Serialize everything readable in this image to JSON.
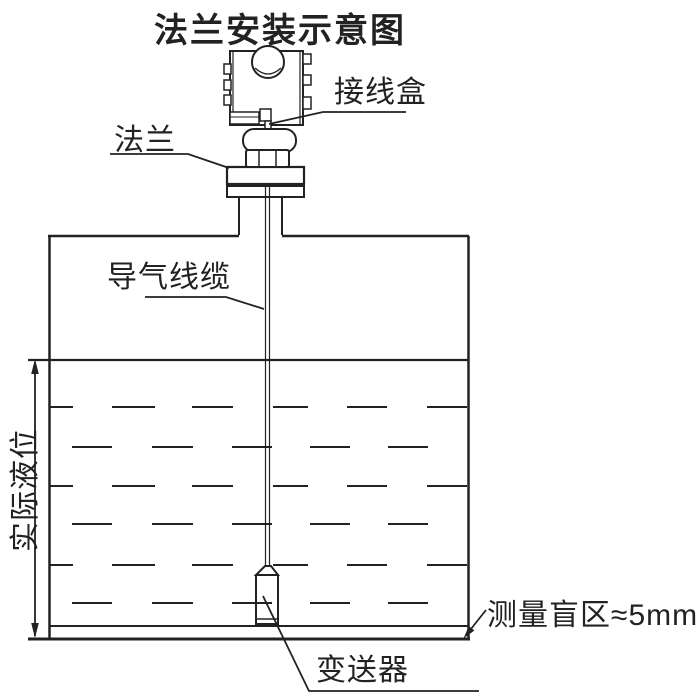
{
  "title": "法兰安装示意图",
  "labels": {
    "junction_box": "接线盒",
    "flange": "法兰",
    "vent_cable": "导气线缆",
    "actual_level": "实际液位",
    "transmitter": "变送器",
    "blind_zone": "测量盲区≈5mm"
  },
  "colors": {
    "ink": "#222222",
    "background": "#ffffff"
  },
  "liquid": {
    "level_y": 360,
    "dash_rows": [
      {
        "y": 407,
        "pattern": "A"
      },
      {
        "y": 447,
        "pattern": "B"
      },
      {
        "y": 486,
        "pattern": "A"
      },
      {
        "y": 524,
        "pattern": "B"
      },
      {
        "y": 565,
        "pattern": "A"
      },
      {
        "y": 603,
        "pattern": "B"
      }
    ],
    "patterns": {
      "A": [
        [
          50,
          73
        ],
        [
          112,
          155
        ],
        [
          192,
          233
        ],
        [
          273,
          308
        ],
        [
          347,
          387
        ],
        [
          427,
          467
        ]
      ],
      "B": [
        [
          72,
          112
        ],
        [
          152,
          193
        ],
        [
          232,
          272
        ],
        [
          310,
          350
        ],
        [
          388,
          428
        ]
      ]
    }
  }
}
